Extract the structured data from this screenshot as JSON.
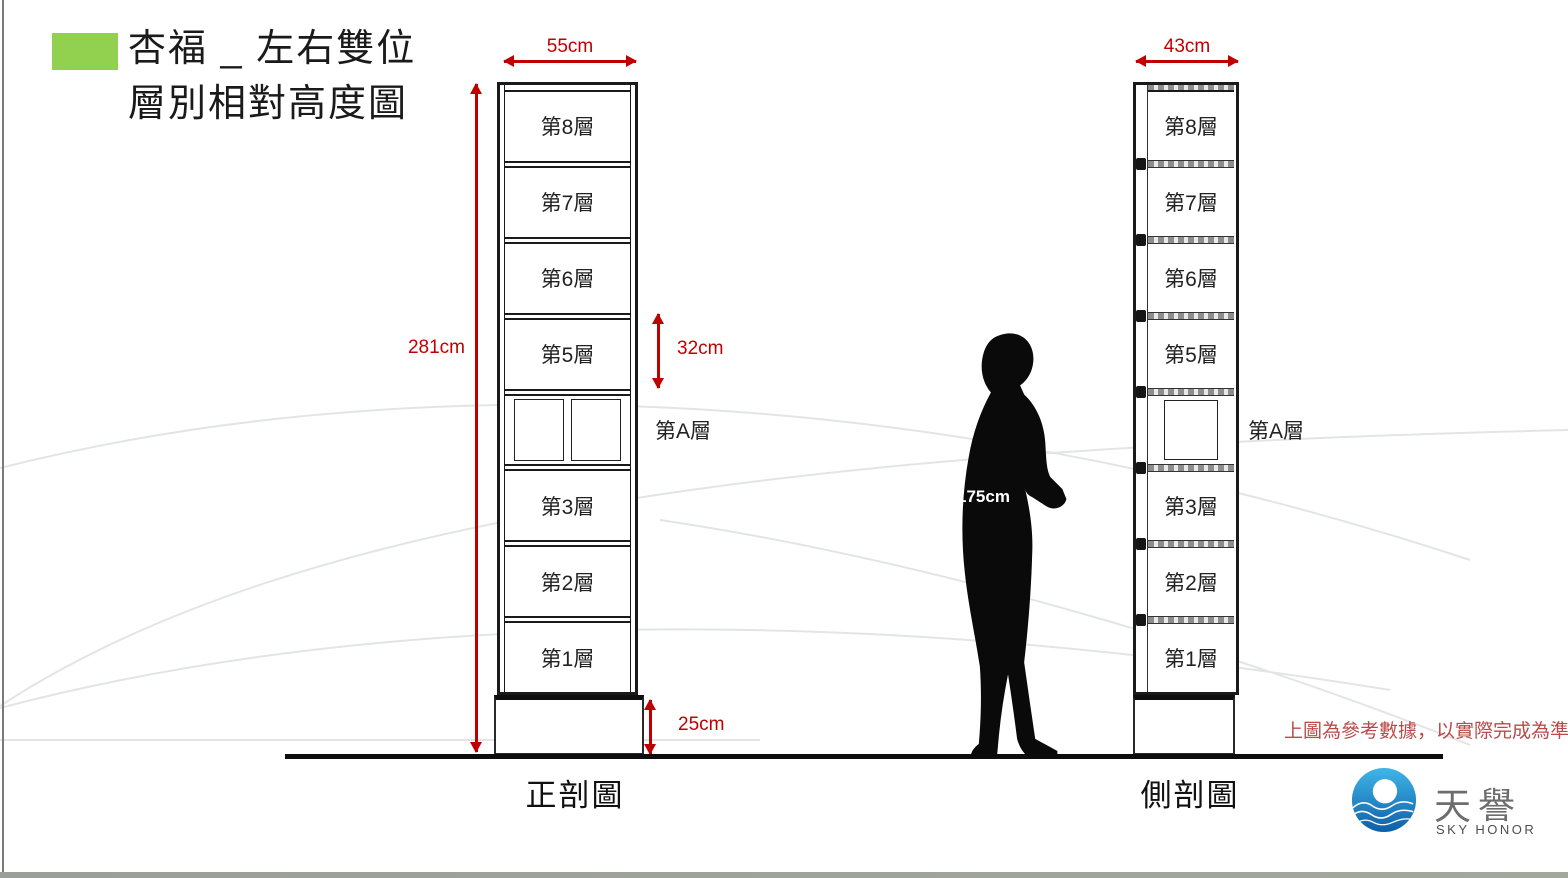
{
  "slide": {
    "title_line1": "杏福 _ 左右雙位",
    "title_line2": "層別相對高度圖"
  },
  "front_view": {
    "caption": "正剖圖",
    "width_label": "55cm",
    "height_label": "281cm",
    "cell_height_label": "32cm",
    "base_height_label": "25cm",
    "a_layer_label": "第A層",
    "layers": [
      "第8層",
      "第7層",
      "第6層",
      "第5層",
      "",
      "第3層",
      "第2層",
      "第1層"
    ]
  },
  "side_view": {
    "caption": "側剖圖",
    "width_label": "43cm",
    "a_layer_label": "第A層",
    "layers": [
      "第8層",
      "第7層",
      "第6層",
      "第5層",
      "",
      "第3層",
      "第2層",
      "第1層"
    ]
  },
  "person": {
    "height_label": "175cm"
  },
  "footer": {
    "disclaimer": "上圖為參考數據，以實際完成為準",
    "logo_name": "天譽",
    "logo_subtitle": "SKY HONOR"
  },
  "colors": {
    "dimension_red": "#C00000",
    "disclaimer_red": "#B94A48",
    "title_accent_green": "#92D050",
    "logo_blue_light": "#3FB6E8",
    "logo_blue_dark": "#0E5FA8",
    "ground_black": "#0D0D0D"
  }
}
